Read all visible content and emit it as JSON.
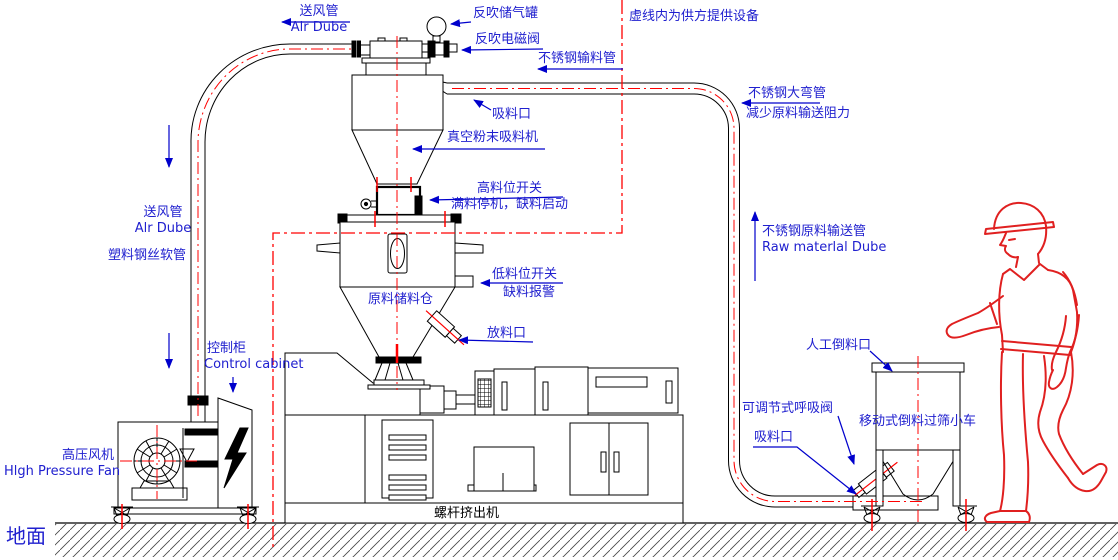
{
  "colors": {
    "label_blue": "#2020cf",
    "leader_blue": "#0000cc",
    "centerline_red": "#ff0000",
    "line_black": "#000000"
  },
  "labels": {
    "air_pipe_top": {
      "line1": "送风管",
      "line2": "Alr Dube"
    },
    "blowback_tank": {
      "text": "反吹储气罐"
    },
    "blowback_valve": {
      "text": "反吹电磁阀"
    },
    "ss_feed_pipe": {
      "text": "不锈钢输料管"
    },
    "boundary_note": {
      "text": "虚线内为供方提供设备"
    },
    "suction_port_top": {
      "text": "吸料口"
    },
    "vacuum_feeder": {
      "text": "真空粉末吸料机"
    },
    "high_level_switch": {
      "line1": "高料位开关",
      "line2": "满料停机，缺料启动"
    },
    "ss_bend_pipe": {
      "line1": "不锈钢大弯管",
      "line2": "减少原料输送阻力"
    },
    "air_pipe_left": {
      "line1": "送风管",
      "line2": "Alr Dube"
    },
    "plastic_hose": {
      "text": "塑料钢丝软管"
    },
    "low_level_switch": {
      "line1": "低料位开关",
      "line2": "缺料报警"
    },
    "storage_bin": {
      "text": "原料储料仓"
    },
    "discharge_port": {
      "text": "放料口"
    },
    "control_cabinet": {
      "line1": "控制柜",
      "line2": "Control cabinet"
    },
    "raw_material_pipe": {
      "line1": "不锈钢原料输送管",
      "line2": "Raw materlal Dube"
    },
    "manual_pour_port": {
      "text": "人工倒料口"
    },
    "high_pressure_fan": {
      "line1": "高压风机",
      "line2": "Hlgh Pressure Fan"
    },
    "breathing_valve": {
      "text": "可调节式呼吸阀"
    },
    "suction_port_bottom": {
      "text": "吸料口"
    },
    "mobile_cart": {
      "text": "移动式倒料过筛小车"
    },
    "screw_extruder": {
      "text": "螺杆挤出机"
    },
    "ground": {
      "text": "地面"
    }
  }
}
